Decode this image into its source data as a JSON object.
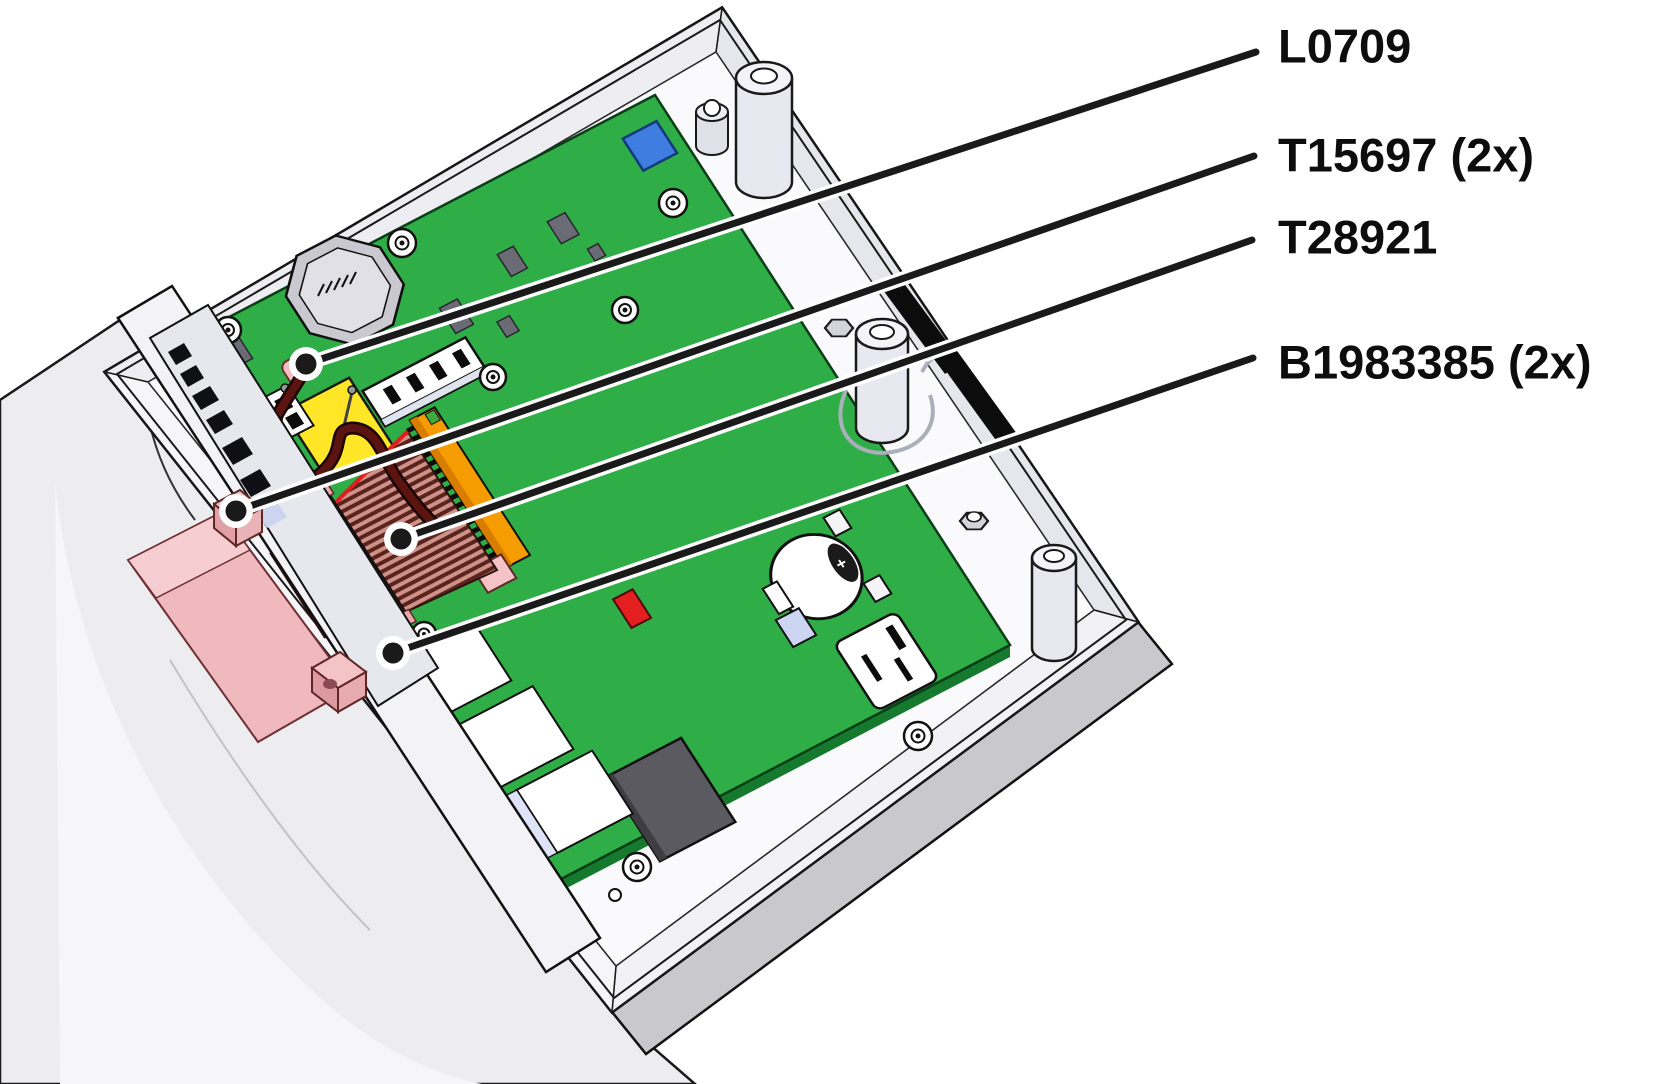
{
  "diagram": {
    "kind": "parts-callout-illustration",
    "scene": "open device enclosure with main circuit board"
  },
  "callouts": [
    {
      "id": "l0709",
      "label": "L0709",
      "target": "wire-inductor"
    },
    {
      "id": "t15697",
      "label": "T15697 (2x)",
      "target": "pink-standoff-block"
    },
    {
      "id": "t28921",
      "label": "T28921",
      "target": "ribbon-cable"
    },
    {
      "id": "b1983385",
      "label": "B1983385 (2x)",
      "target": "board-edge-bracket"
    }
  ],
  "battery": {
    "polarity_marking": "+"
  },
  "colors": {
    "pcb": "#2fae48",
    "pcb_edge": "#157a2e",
    "case": "#ffffff",
    "case_shadow": "#c9c9cd",
    "outline": "#111111",
    "label_text": "#0d0d0d",
    "leader": "#1a1a1a",
    "blue_component": "#3f7de0",
    "yellow_component": "#ffe728",
    "orange_connector": "#f59d00",
    "red_component": "#e31f1f",
    "ribbon_dark": "#5a241e",
    "ribbon_light": "#cf9187",
    "wire": "#5c1410",
    "pink_part": "#f2c0c2",
    "chip_gray": "#6b6b75",
    "big_chip": "#5a5a60",
    "lavender": "#dfe3f8"
  }
}
